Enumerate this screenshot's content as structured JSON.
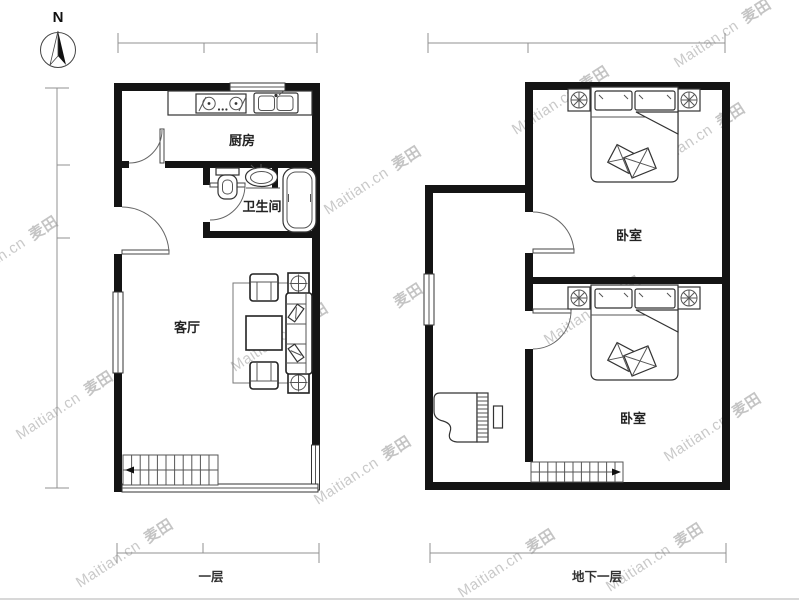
{
  "compass": {
    "north_label": "N"
  },
  "floor1": {
    "label": "一层",
    "rooms": {
      "kitchen": "厨房",
      "bathroom": "卫生间",
      "living_room": "客厅"
    }
  },
  "basement": {
    "label": "地下一层",
    "rooms": {
      "bedroom_upper": "卧室",
      "bedroom_lower": "卧室"
    }
  },
  "watermark": {
    "text": "Maitian.cn",
    "logo": "麦田",
    "color": "#c9c9c9"
  },
  "colors": {
    "wall": "#141414",
    "fixture_stroke": "#333333",
    "dimension_line": "#909090",
    "label_text": "#222222"
  }
}
